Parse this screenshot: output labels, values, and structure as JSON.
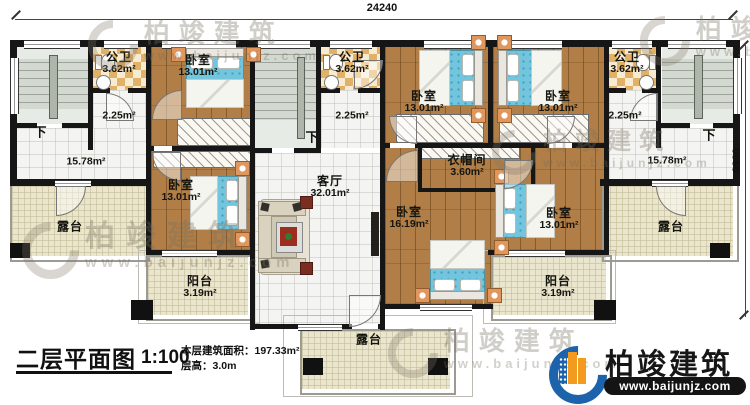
{
  "dimensions": {
    "top": "24240",
    "right": "9900"
  },
  "labels": {
    "down": "下"
  },
  "rooms": {
    "bath1": {
      "name": "公卫",
      "area": "3.62m²"
    },
    "bath2": {
      "name": "公卫",
      "area": "3.62m²"
    },
    "bath3": {
      "name": "公卫",
      "area": "3.62m²"
    },
    "hall1": {
      "area": "2.25m²"
    },
    "hall2": {
      "area": "2.25m²"
    },
    "hall3": {
      "area": "2.25m²"
    },
    "bed1": {
      "name": "卧室",
      "area": "13.01m²"
    },
    "bed2": {
      "name": "卧室",
      "area": "13.01m²"
    },
    "bed3": {
      "name": "卧室",
      "area": "13.01m²"
    },
    "bed4": {
      "name": "卧室",
      "area": "13.01m²"
    },
    "bed5": {
      "name": "卧室",
      "area": "16.19m²"
    },
    "bed6": {
      "name": "卧室",
      "area": "13.01m²"
    },
    "family1": {
      "area": "15.78m²"
    },
    "family2": {
      "area": "15.78m²"
    },
    "living": {
      "name": "客厅",
      "area": "32.01m²"
    },
    "cloak": {
      "name": "衣帽间",
      "area": "3.60m²"
    },
    "terrace_left": {
      "name": "露台"
    },
    "terrace_right": {
      "name": "露台"
    },
    "terrace_bottom": {
      "name": "露台"
    },
    "balcony_left": {
      "name": "阳台",
      "area": "3.19m²"
    },
    "balcony_right": {
      "name": "阳台",
      "area": "3.19m²"
    }
  },
  "title_block": {
    "title": "二层平面图",
    "scale": "1:100",
    "area_line": "本层建筑面积：197.33m²",
    "height_line": "层高：3.0m"
  },
  "brand": {
    "name": "柏竣建筑",
    "url": "www.baijunjz.com"
  },
  "colors": {
    "wall": "#161616",
    "wood_floor": "#b07e46",
    "bed_blue": "#72c5dc",
    "bath_tile": "#e2b168",
    "terrace": "#eae5cd",
    "logo_blue": "#1d63ac",
    "logo_orange": "#f29b1f"
  }
}
